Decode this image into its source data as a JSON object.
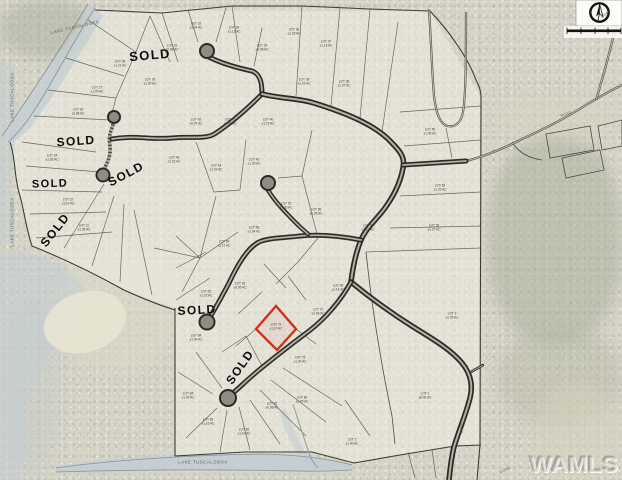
{
  "watermark": {
    "text": "WAMLS"
  },
  "compass": {
    "box": {
      "x": 576,
      "y": 0,
      "w": 46,
      "h": 26
    },
    "cx": 599.5,
    "cy": 12.5,
    "r": 9.2
  },
  "scale_bar": {
    "x": 567,
    "y": 29.5,
    "w": 54,
    "h": 2.6,
    "ticks": [
      567,
      581,
      595,
      608,
      621
    ]
  },
  "map": {
    "sold_text": "SOLD",
    "lake_text": "LAKE TUSCALOOSA",
    "colors": {
      "water": "#c3cdd4",
      "lot_line": "#4a4a42",
      "boundary": "#3c3b34",
      "road_dark": "#2b2a25",
      "road_fill": "#b2b0a6",
      "red_lot": "#d2301f"
    },
    "terrain_patches": [
      {
        "x": 488,
        "y": 135,
        "w": 134,
        "h": 210,
        "c": "rgba(168,173,154,0.50)"
      },
      {
        "x": 498,
        "y": 330,
        "w": 124,
        "h": 95,
        "c": "rgba(176,179,160,0.38)"
      },
      {
        "x": 0,
        "y": 0,
        "w": 95,
        "h": 58,
        "c": "rgba(165,170,152,0.45)"
      },
      {
        "x": 535,
        "y": 385,
        "w": 87,
        "h": 95,
        "c": "rgba(214,209,188,0.55)"
      },
      {
        "x": 55,
        "y": 250,
        "w": 125,
        "h": 120,
        "c": "rgba(219,216,199,0.60)"
      },
      {
        "x": 0,
        "y": 300,
        "w": 58,
        "h": 180,
        "c": "rgba(198,203,200,0.50)"
      },
      {
        "x": 490,
        "y": 95,
        "w": 132,
        "h": 45,
        "c": "rgba(213,211,192,0.50)"
      }
    ],
    "plat_fill": "95,10 430,11 481,97 480,445 455,446 400,455 354,463 312,452 175,456 175,308 124,290 32,246 20,196 10,142 44,98",
    "water": [
      {
        "name": "lake-band-nw",
        "points": "95,8 103,16 60,86 30,128 14,142 2,136 20,108 50,66 80,24 88,4",
        "opacity": 0.75
      },
      {
        "name": "lake-strip-left",
        "points": "0,60 14,64 18,120 10,180 16,240 0,246",
        "opacity": 0.5
      },
      {
        "name": "lake-sw",
        "points": "0,250 34,254 60,264 82,284 92,302 76,326 50,354 30,386 24,416 30,446 16,480 0,480",
        "opacity": 0.55
      },
      {
        "name": "lake-inlet-south",
        "points": "56,466 120,458 200,454 262,453 312,456 352,464 352,470 300,472 238,470 160,470 98,473 56,472",
        "opacity": 0.9
      },
      {
        "name": "creek-arm",
        "points": "285,408 295,432 305,452 318,463 312,469 296,452 286,432 279,412",
        "opacity": 0.6
      }
    ],
    "sand": {
      "cx": 85,
      "cy": 322,
      "rx": 42,
      "ry": 30,
      "rot": -18
    },
    "shorelines": [
      "M95,8 C80,30 60,68 42,98 C30,118 18,134 8,142",
      "M2,136 C20,110 50,66 88,4",
      "M56,468 C120,459 200,455 262,454 C300,455 330,459 352,465",
      "M56,472 C120,470 200,469 300,471 C330,472 345,470 352,470"
    ],
    "boundary": [
      "M95,10 L162,13 L232,6 L302,6 L370,9 L430,11",
      "M430,11 C450,32 468,58 476,80 C480,88 481,92 481,97",
      "M481,97 L480,445 L477,480",
      "M175,308 L175,456",
      "M175,456 L245,452 L312,452 L354,463",
      "M354,463 L400,455 L455,446 L481,445",
      "M32,246 C62,258 95,274 124,290 C146,300 162,306 175,310",
      "M10,142 C16,160 14,178 20,196 C24,210 26,228 32,246"
    ],
    "lot_lines": [
      [
        88,
        20,
        136,
        52
      ],
      [
        66,
        58,
        124,
        76
      ],
      [
        48,
        90,
        116,
        98
      ],
      [
        34,
        116,
        110,
        120
      ],
      [
        136,
        52,
        150,
        16
      ],
      [
        116,
        98,
        136,
        52
      ],
      [
        110,
        120,
        116,
        98
      ],
      [
        150,
        16,
        170,
        62
      ],
      [
        162,
        13,
        178,
        62
      ],
      [
        188,
        10,
        198,
        42
      ],
      [
        226,
        8,
        216,
        42
      ],
      [
        232,
        6,
        240,
        62
      ],
      [
        262,
        28,
        254,
        66
      ],
      [
        302,
        6,
        296,
        96
      ],
      [
        340,
        8,
        331,
        106
      ],
      [
        370,
        9,
        360,
        118
      ],
      [
        398,
        22,
        382,
        132
      ],
      [
        22,
        142,
        96,
        152
      ],
      [
        26,
        166,
        100,
        172
      ],
      [
        22,
        190,
        102,
        192
      ],
      [
        30,
        214,
        106,
        212
      ],
      [
        36,
        238,
        112,
        232
      ],
      [
        104,
        184,
        64,
        248
      ],
      [
        114,
        196,
        92,
        266
      ],
      [
        124,
        204,
        120,
        282
      ],
      [
        134,
        210,
        152,
        295
      ],
      [
        196,
        142,
        214,
        192
      ],
      [
        246,
        140,
        240,
        190
      ],
      [
        214,
        192,
        240,
        190
      ],
      [
        200,
        258,
        216,
        196
      ],
      [
        200,
        258,
        238,
        232
      ],
      [
        200,
        258,
        176,
        236
      ],
      [
        200,
        258,
        182,
        292
      ],
      [
        200,
        258,
        154,
        248
      ],
      [
        302,
        176,
        312,
        130
      ],
      [
        302,
        176,
        278,
        178
      ],
      [
        302,
        176,
        318,
        238
      ],
      [
        318,
        238,
        298,
        262
      ],
      [
        298,
        262,
        276,
        284
      ],
      [
        262,
        292,
        238,
        314
      ],
      [
        286,
        288,
        264,
        264
      ],
      [
        306,
        300,
        288,
        276
      ],
      [
        256,
        329,
        236,
        346
      ],
      [
        296,
        329,
        316,
        344
      ],
      [
        176,
        268,
        206,
        252
      ],
      [
        176,
        300,
        210,
        278
      ],
      [
        400,
        112,
        481,
        106
      ],
      [
        404,
        146,
        481,
        140
      ],
      [
        400,
        196,
        481,
        192
      ],
      [
        390,
        228,
        481,
        226
      ],
      [
        366,
        252,
        481,
        248
      ],
      [
        446,
        128,
        452,
        158
      ],
      [
        222,
        388,
        196,
        352
      ],
      [
        213,
        394,
        178,
        372
      ],
      [
        217,
        408,
        186,
        438
      ],
      [
        227,
        410,
        220,
        452
      ],
      [
        239,
        407,
        250,
        450
      ],
      [
        250,
        400,
        280,
        444
      ],
      [
        260,
        390,
        306,
        436
      ],
      [
        271,
        380,
        326,
        422
      ],
      [
        283,
        368,
        342,
        406
      ],
      [
        262,
        366,
        246,
        336
      ],
      [
        246,
        336,
        222,
        352
      ],
      [
        345,
        400,
        370,
        436
      ],
      [
        408,
        452,
        415,
        478
      ],
      [
        432,
        450,
        436,
        478
      ]
    ],
    "lot_paths": [
      "M366,252 C372,310 382,368 392,416 L395,444",
      "M512,142 C518,152 528,158 542,160"
    ],
    "parcels": [
      "546,134 590,126 594,150 550,158",
      "598,126 622,120 622,146 602,150",
      "562,158 600,150 604,170 566,178"
    ],
    "thin_roads": [
      "M466,161 C482,157 498,151 516,142 C546,128 566,118 586,105 C602,95 614,89 622,85",
      "M596,100 C604,74 612,44 620,8",
      "M429,9 C431,40 432,72 434,96 C436,112 439,121 445,125 C453,129 461,124 463,112 C466,94 466,56 466,12"
    ],
    "creek": "M293,404 C298,420 304,438 308,450 C310,458 313,463 318,468",
    "stem_road": "M114,121 C111,133 108,134 110,146 C111,158 106,164 104,170",
    "roads": [
      {
        "d": "M207,56 C220,63 238,68 252,71 C260,74 262,82 262,94",
        "w": 5
      },
      {
        "d": "M112,139 C135,135 152,140 172,138 C192,136 206,140 216,133 C234,121 248,108 262,94",
        "w": 5
      },
      {
        "d": "M262,94 C282,99 298,98 314,103 C346,113 376,125 392,143 C402,153 405,159 403,168 C400,185 392,198 385,208 C377,219 366,228 361,240 C356,252 353,266 351,282",
        "w": 5.5
      },
      {
        "d": "M403,165 L466,161",
        "w": 5
      },
      {
        "d": "M361,240 C340,236 320,234 300,236 C281,238 268,238 259,242 C247,248 237,266 229,283 C221,298 215,309 210,317",
        "w": 5
      },
      {
        "d": "M268,190 C275,202 287,214 299,226 L308,234",
        "w": 4.5
      },
      {
        "d": "M351,282 C368,296 391,313 415,328 C438,342 452,351 462,363 C471,374 473,386 470,398 C466,414 459,430 454,447 C451,459 450,470 449,480",
        "w": 5.5
      },
      {
        "d": "M351,282 C341,300 326,318 309,331 C293,343 276,356 259,370 C248,379 239,388 233,393",
        "w": 5
      },
      {
        "d": "M471,372 L483,365",
        "w": 2.5
      }
    ],
    "cul_de_sacs": [
      [
        207,
        51,
        7
      ],
      [
        268,
        183,
        7
      ],
      [
        114,
        117,
        6
      ],
      [
        103,
        175,
        6.5
      ],
      [
        207,
        322,
        7.5
      ],
      [
        228,
        398,
        8
      ]
    ],
    "red_lot": {
      "points": "276,306 256,329 277,350 296,329",
      "label1": "LOT 73",
      "label2": "±1.10 AC"
    },
    "sold_labels": [
      {
        "x": 150,
        "y": 55,
        "rot": -5,
        "s": 13
      },
      {
        "x": 76,
        "y": 141,
        "rot": -4,
        "s": 12
      },
      {
        "x": 126,
        "y": 174,
        "rot": -28,
        "s": 12
      },
      {
        "x": 50,
        "y": 184,
        "rot": -2,
        "s": 11
      },
      {
        "x": 55,
        "y": 230,
        "rot": -52,
        "s": 12
      },
      {
        "x": 197,
        "y": 310,
        "rot": -3,
        "s": 12
      },
      {
        "x": 240,
        "y": 367,
        "rot": -55,
        "s": 12
      }
    ],
    "lake_labels": [
      {
        "x": 75,
        "y": 27,
        "rot": -13
      },
      {
        "x": 12,
        "y": 97,
        "rot": -90
      },
      {
        "x": 12,
        "y": 222,
        "rot": -90
      },
      {
        "x": 203,
        "y": 462,
        "rot": 0
      }
    ],
    "road_labels": [
      {
        "x": 566,
        "y": 114,
        "rot": -21,
        "text": "ROAD"
      },
      {
        "x": 606,
        "y": 14,
        "rot": -40,
        "text": "ROAD"
      },
      {
        "x": 505,
        "y": 470,
        "rot": -27,
        "text": "ROAD"
      },
      {
        "x": 461,
        "y": 428,
        "rot": 83,
        "text": "ROAD"
      }
    ],
    "lot_labels": [
      [
        120,
        64,
        "LOT 28",
        "±1.21 AC"
      ],
      [
        97,
        90,
        "LOT 27",
        "±1.05 AC"
      ],
      [
        78,
        112,
        "LOT 26",
        "±0.98 AC"
      ],
      [
        52,
        158,
        "LOT 24",
        "±1.02 AC"
      ],
      [
        68,
        202,
        "LOT 22",
        "±1.10 AC"
      ],
      [
        84,
        228,
        "LOT 21",
        "±1.35 AC"
      ],
      [
        150,
        82,
        "LOT 30",
        "±1.00 AC"
      ],
      [
        172,
        48,
        "LOT 31",
        "±0.96 AC"
      ],
      [
        196,
        26,
        "LOT 32",
        "±1.04 AC"
      ],
      [
        234,
        30,
        "LOT 34",
        "±1.12 AC"
      ],
      [
        262,
        48,
        "LOT 35",
        "±0.99 AC"
      ],
      [
        294,
        32,
        "LOT 36",
        "±1.25 AC"
      ],
      [
        326,
        44,
        "LOT 37",
        "±1.18 AC"
      ],
      [
        344,
        84,
        "LOT 38",
        "±1.07 AC"
      ],
      [
        304,
        82,
        "LOT 39",
        "±1.01 AC"
      ],
      [
        268,
        122,
        "LOT 40",
        "±1.15 AC"
      ],
      [
        230,
        122,
        "LOT 41",
        "±1.09 AC"
      ],
      [
        196,
        122,
        "LOT 42",
        "±0.97 AC"
      ],
      [
        174,
        160,
        "LOT 43",
        "±1.22 AC"
      ],
      [
        216,
        168,
        "LOT 44",
        "±1.03 AC"
      ],
      [
        254,
        162,
        "LOT 45",
        "±1.00 AC"
      ],
      [
        286,
        206,
        "LOT 57",
        "±1.30 AC"
      ],
      [
        316,
        212,
        "LOT 56",
        "±1.08 AC"
      ],
      [
        254,
        230,
        "LOT 58",
        "±1.04 AC"
      ],
      [
        224,
        244,
        "LOT 59",
        "±1.11 AC"
      ],
      [
        206,
        294,
        "LOT 62",
        "±1.02 AC"
      ],
      [
        240,
        286,
        "LOT 63",
        "±0.95 AC"
      ],
      [
        318,
        312,
        "LOT 70",
        "±1.06 AC"
      ],
      [
        338,
        288,
        "LOT 69",
        "±1.14 AC"
      ],
      [
        300,
        360,
        "LOT 75",
        "±1.00 AC"
      ],
      [
        368,
        228,
        "LOT 55",
        "±1.21 AC"
      ],
      [
        430,
        132,
        "LOT 50",
        "±1.45 AC"
      ],
      [
        440,
        188,
        "LOT 52",
        "±1.33 AC"
      ],
      [
        434,
        228,
        "LOT 53",
        "±1.27 AC"
      ],
      [
        425,
        396,
        "LOT 1",
        "±8.40 AC"
      ],
      [
        352,
        442,
        "LOT 2",
        "±1.60 AC"
      ],
      [
        302,
        400,
        "LOT 80",
        "±1.05 AC"
      ],
      [
        272,
        406,
        "LOT 81",
        "±0.98 AC"
      ],
      [
        244,
        432,
        "LOT 82",
        "±1.10 AC"
      ],
      [
        208,
        422,
        "LOT 83",
        "±1.16 AC"
      ],
      [
        188,
        396,
        "LOT 84",
        "±1.00 AC"
      ],
      [
        196,
        338,
        "LOT 64",
        "±1.09 AC"
      ],
      [
        452,
        316,
        "LOT 3",
        "±2.05 AC"
      ]
    ]
  }
}
